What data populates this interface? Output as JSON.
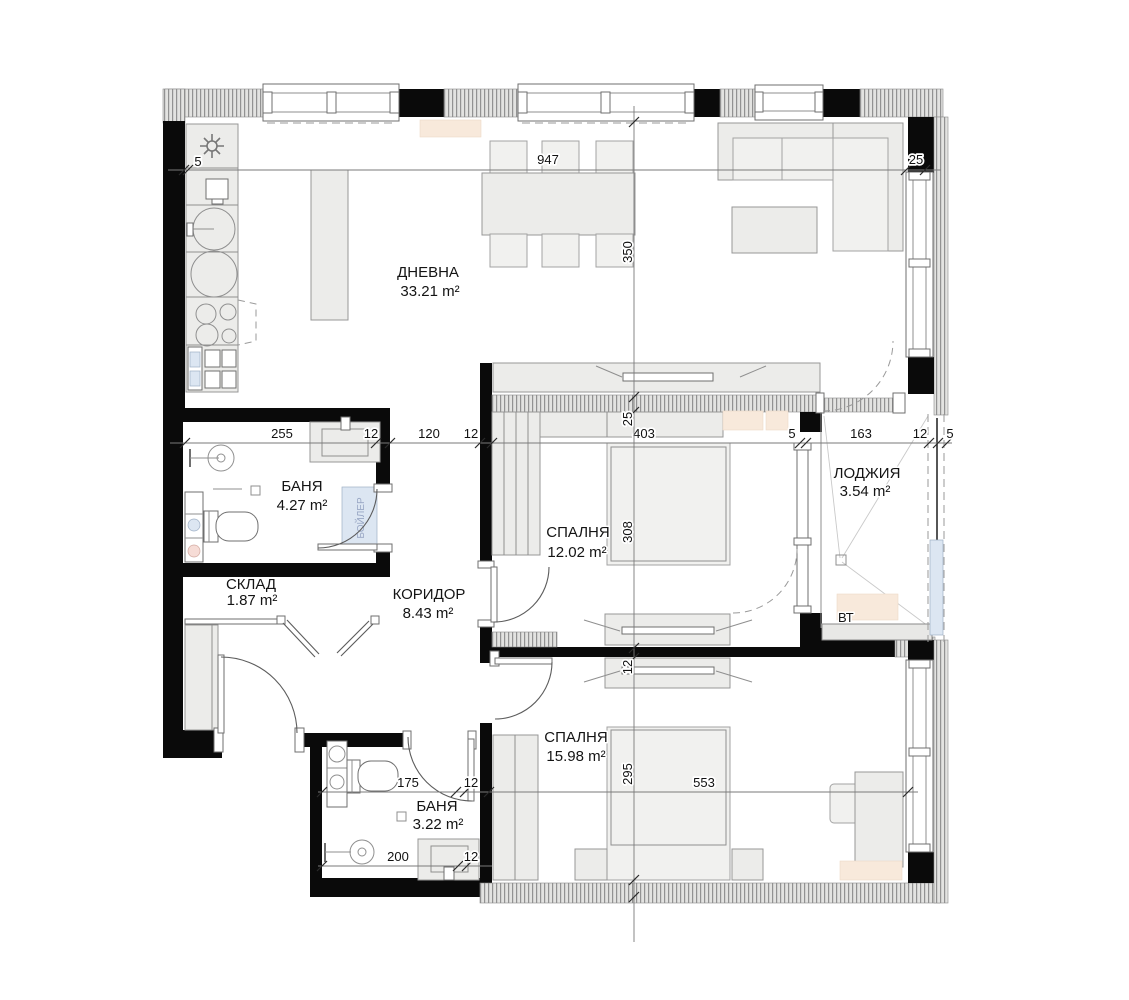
{
  "rooms": [
    {
      "id": "dnevna",
      "name": "ДНЕВНА",
      "area": "33.21 m²"
    },
    {
      "id": "banya1",
      "name": "БАНЯ",
      "area": "4.27 m²"
    },
    {
      "id": "sklad",
      "name": "СКЛАД",
      "area": "1.87 m²"
    },
    {
      "id": "koridor",
      "name": "КОРИДОР",
      "area": "8.43 m²"
    },
    {
      "id": "spalnya1",
      "name": "СПАЛНЯ",
      "area": "12.02 m²"
    },
    {
      "id": "lodzhiya",
      "name": "ЛОДЖИЯ",
      "area": "3.54 m²"
    },
    {
      "id": "spalnya2",
      "name": "СПАЛНЯ",
      "area": "15.98 m²"
    },
    {
      "id": "banya2",
      "name": "БАНЯ",
      "area": "3.22 m²"
    }
  ],
  "annotations": {
    "outdoor_unit": "ВТ",
    "boiler": "БОЙЛЕР"
  },
  "dimensions": {
    "top": [
      "5",
      "947",
      "25"
    ],
    "middle": [
      "255",
      "12",
      "120",
      "12",
      "403",
      "5",
      "163",
      "12",
      "5"
    ],
    "vertical": [
      "350",
      "25",
      "308",
      "12",
      "295"
    ],
    "bedroom2_width": "553",
    "bath2_upper": [
      "175",
      "12"
    ],
    "bath2_lower": [
      "200",
      "12"
    ]
  },
  "colors": {
    "wall": "#0a0a0a",
    "hatch_fill": "#e3e3e1",
    "furniture": "#ececea",
    "ac_unit": "#f8e9db",
    "boiler_fill": "#e4edf8"
  }
}
